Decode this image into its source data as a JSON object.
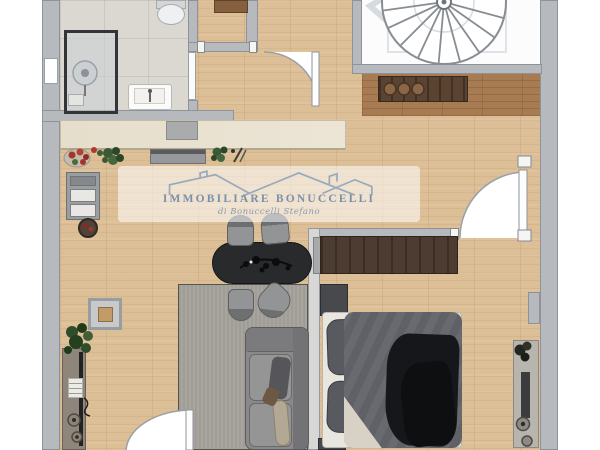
{
  "watermark": {
    "agency_name": "IMMOBILIARE BONUCCELLI",
    "agency_subtitle": "di Bonuccelli Stefano",
    "logo": "rooflines-logo"
  },
  "palette": {
    "background": "#ffffff",
    "wall": "#b6babe",
    "wood_floor": "#dcbf97",
    "dark_wood_floor": "#a87c52",
    "bathroom_tile": "#dbd8d2",
    "staircase_room": "#fcfcfd",
    "rug": "#a8a49e",
    "dining_table": "#292a2c",
    "wardrobe": "#4c3c31",
    "logo_blue": "#8aa0b8"
  },
  "plan_elements": [
    "spiral-staircase",
    "shower",
    "toilet",
    "washbasin",
    "kitchen-counter",
    "sink",
    "cooktop",
    "fridge",
    "fruit-bowl",
    "sideboard",
    "dining-table",
    "dining-chairs",
    "rug",
    "sofa",
    "side-table",
    "wardrobe",
    "double-bed",
    "nightstands",
    "entrance-door",
    "bedroom-door",
    "balcony-door",
    "left-console",
    "right-console",
    "plants"
  ]
}
